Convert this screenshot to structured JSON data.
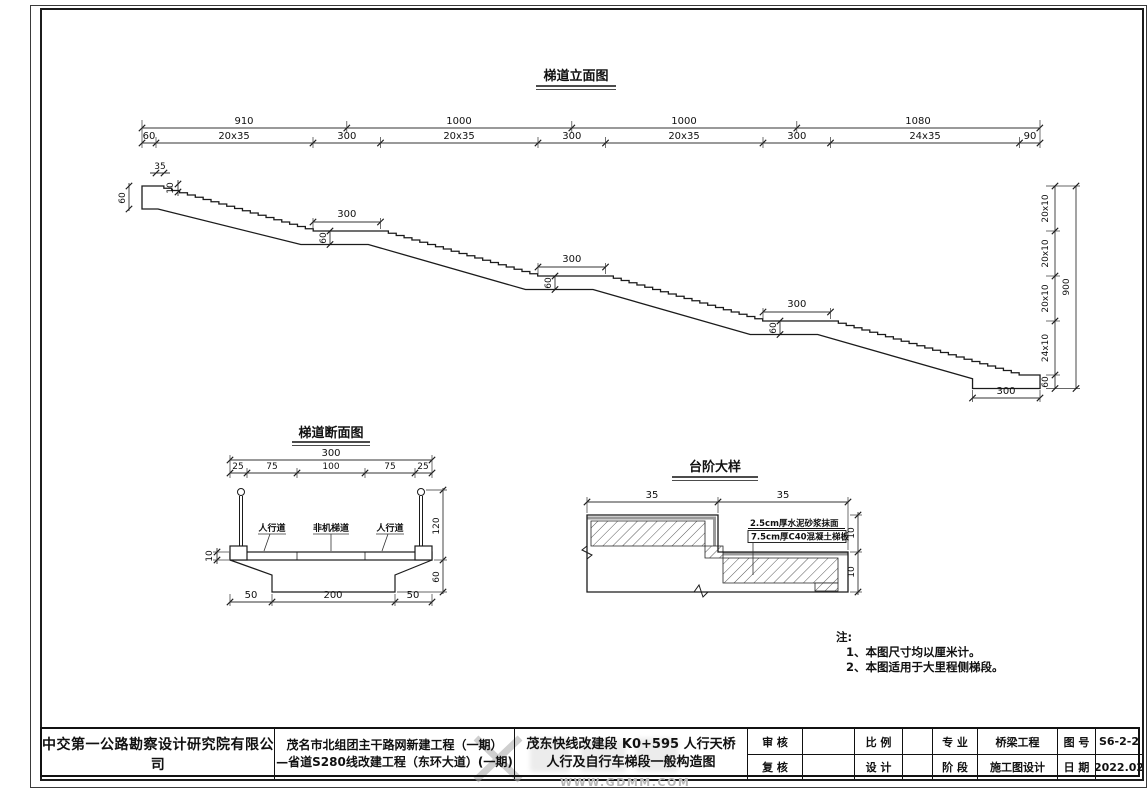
{
  "elevation": {
    "title": "梯道立面图",
    "dims_top": [
      "910",
      "1000",
      "1000",
      "1080"
    ],
    "dims_seg": [
      "60",
      "20x35",
      "300",
      "20x35",
      "300",
      "20x35",
      "300",
      "24x35",
      "90"
    ],
    "dim_landing": "300",
    "dim_landing_thk": "60",
    "dim_entry": "60",
    "dim_tread": "35",
    "dim_riser": "10",
    "dims_right": [
      "20x10",
      "20x10",
      "20x10",
      "24x10",
      "60"
    ],
    "dim_total": "900",
    "dim_footing": "300"
  },
  "cross_section": {
    "title": "梯道断面图",
    "dim_total": "300",
    "dims_sub": [
      "25",
      "75",
      "100",
      "75",
      "25"
    ],
    "lane_labels": [
      "人行道",
      "非机梯道",
      "人行道"
    ],
    "dim_deck": "10",
    "dim_rail": "120",
    "dim_beam": "60",
    "dims_bottom": [
      "50",
      "200",
      "50"
    ]
  },
  "step_detail": {
    "title": "台阶大样",
    "dims_top": [
      "35",
      "35"
    ],
    "callouts": [
      "2.5cm厚水泥砂浆抹面",
      "7.5cm厚C40混凝土梯板"
    ],
    "dims_right": [
      "10",
      "10"
    ]
  },
  "notes": {
    "label": "注:",
    "items": [
      "1、本图尺寸均以厘米计。",
      "2、本图适用于大里程侧梯段。"
    ]
  },
  "title_block": {
    "company": "中交第一公路勘察设计研究院有限公司",
    "project_line1": "茂名市北组团主干路网新建工程（一期）",
    "project_line2": "—省道S280线改建工程（东环大道）(一期)",
    "drawing_line1": "茂东快线改建段 K0+595 人行天桥",
    "drawing_line2": "人行及自行车梯段一般构造图",
    "fields": {
      "shenhe": "审 核",
      "fuhe": "复 核",
      "bili": "比 例",
      "sheji": "设 计",
      "zhuanye": "专 业",
      "zhuanye_val": "桥梁工程",
      "jieduan": "阶 段",
      "jieduan_val": "施工图设计",
      "tuhao": "图 号",
      "tuhao_val": "S6-2-2",
      "riqi": "日 期",
      "riqi_val": "2022.02"
    }
  },
  "watermark": {
    "url": "WWW.GDMM.COM"
  }
}
